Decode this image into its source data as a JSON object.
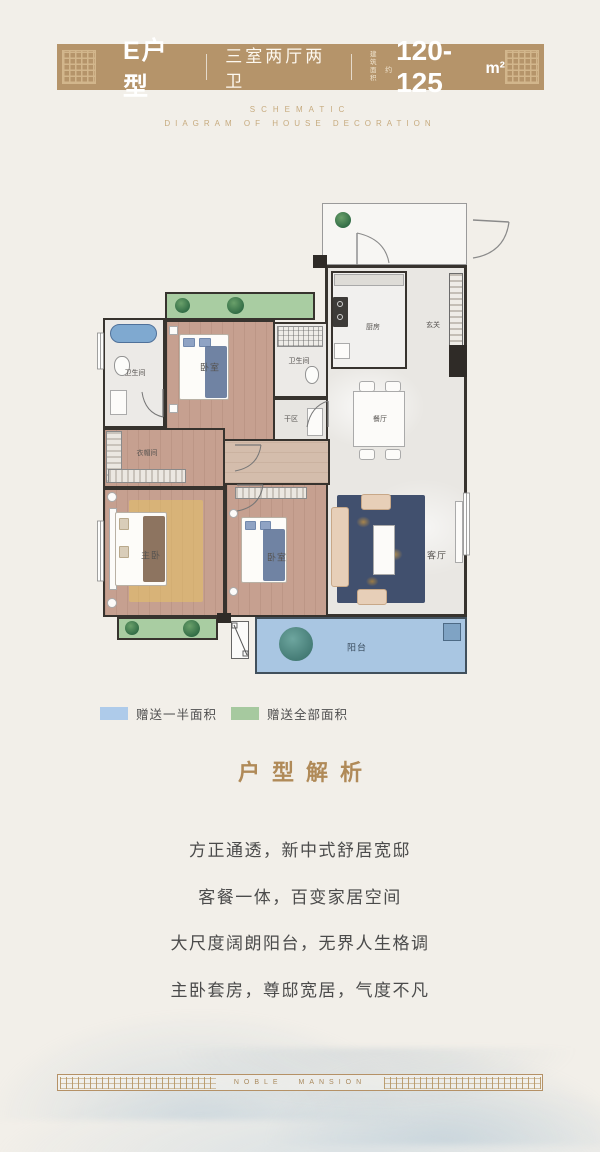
{
  "header": {
    "unit_name": "E户型",
    "layout_type": "三室两厅两卫",
    "area_note_line1": "建筑",
    "area_note_line2": "面积",
    "area_note_suffix": "约",
    "area_value": "120-125",
    "area_unit": "m²"
  },
  "subtitle": {
    "line1": "SCHEMATIC",
    "line2": "DIAGRAM OF HOUSE DECORATION"
  },
  "plan": {
    "rooms": {
      "master": "主卧",
      "bedroom_top": "卧室",
      "bedroom_mid": "卧室",
      "living": "客厅",
      "dining": "餐厅",
      "kitchen": "厨房",
      "foyer": "玄关",
      "bath_left": "卫生间",
      "bath_right": "卫生间",
      "dry_area": "干区",
      "cloakroom": "衣帽间",
      "balcony": "阳台"
    }
  },
  "legend": {
    "items": [
      {
        "label": "赠送一半面积",
        "color": "#aecbea"
      },
      {
        "label": "赠送全部面积",
        "color": "#a6c99f"
      }
    ]
  },
  "analysis": {
    "title": "户型解析",
    "lines": [
      "方正通透，新中式舒居宽邸",
      "客餐一体，百变家居空间",
      "大尺度阔朗阳台，无界人生格调",
      "主卧套房，尊邸宽居，气度不凡"
    ]
  },
  "footer": {
    "brand": "NOBLE MANSION"
  },
  "colors": {
    "header_band": "#b5946a",
    "gold_text": "#b08a58",
    "legend_half": "#aecbea",
    "legend_full": "#a6c99f",
    "balcony_blue": "#a9c6e2",
    "gift_green": "#a9cda2",
    "wall_dark": "#37332e"
  }
}
